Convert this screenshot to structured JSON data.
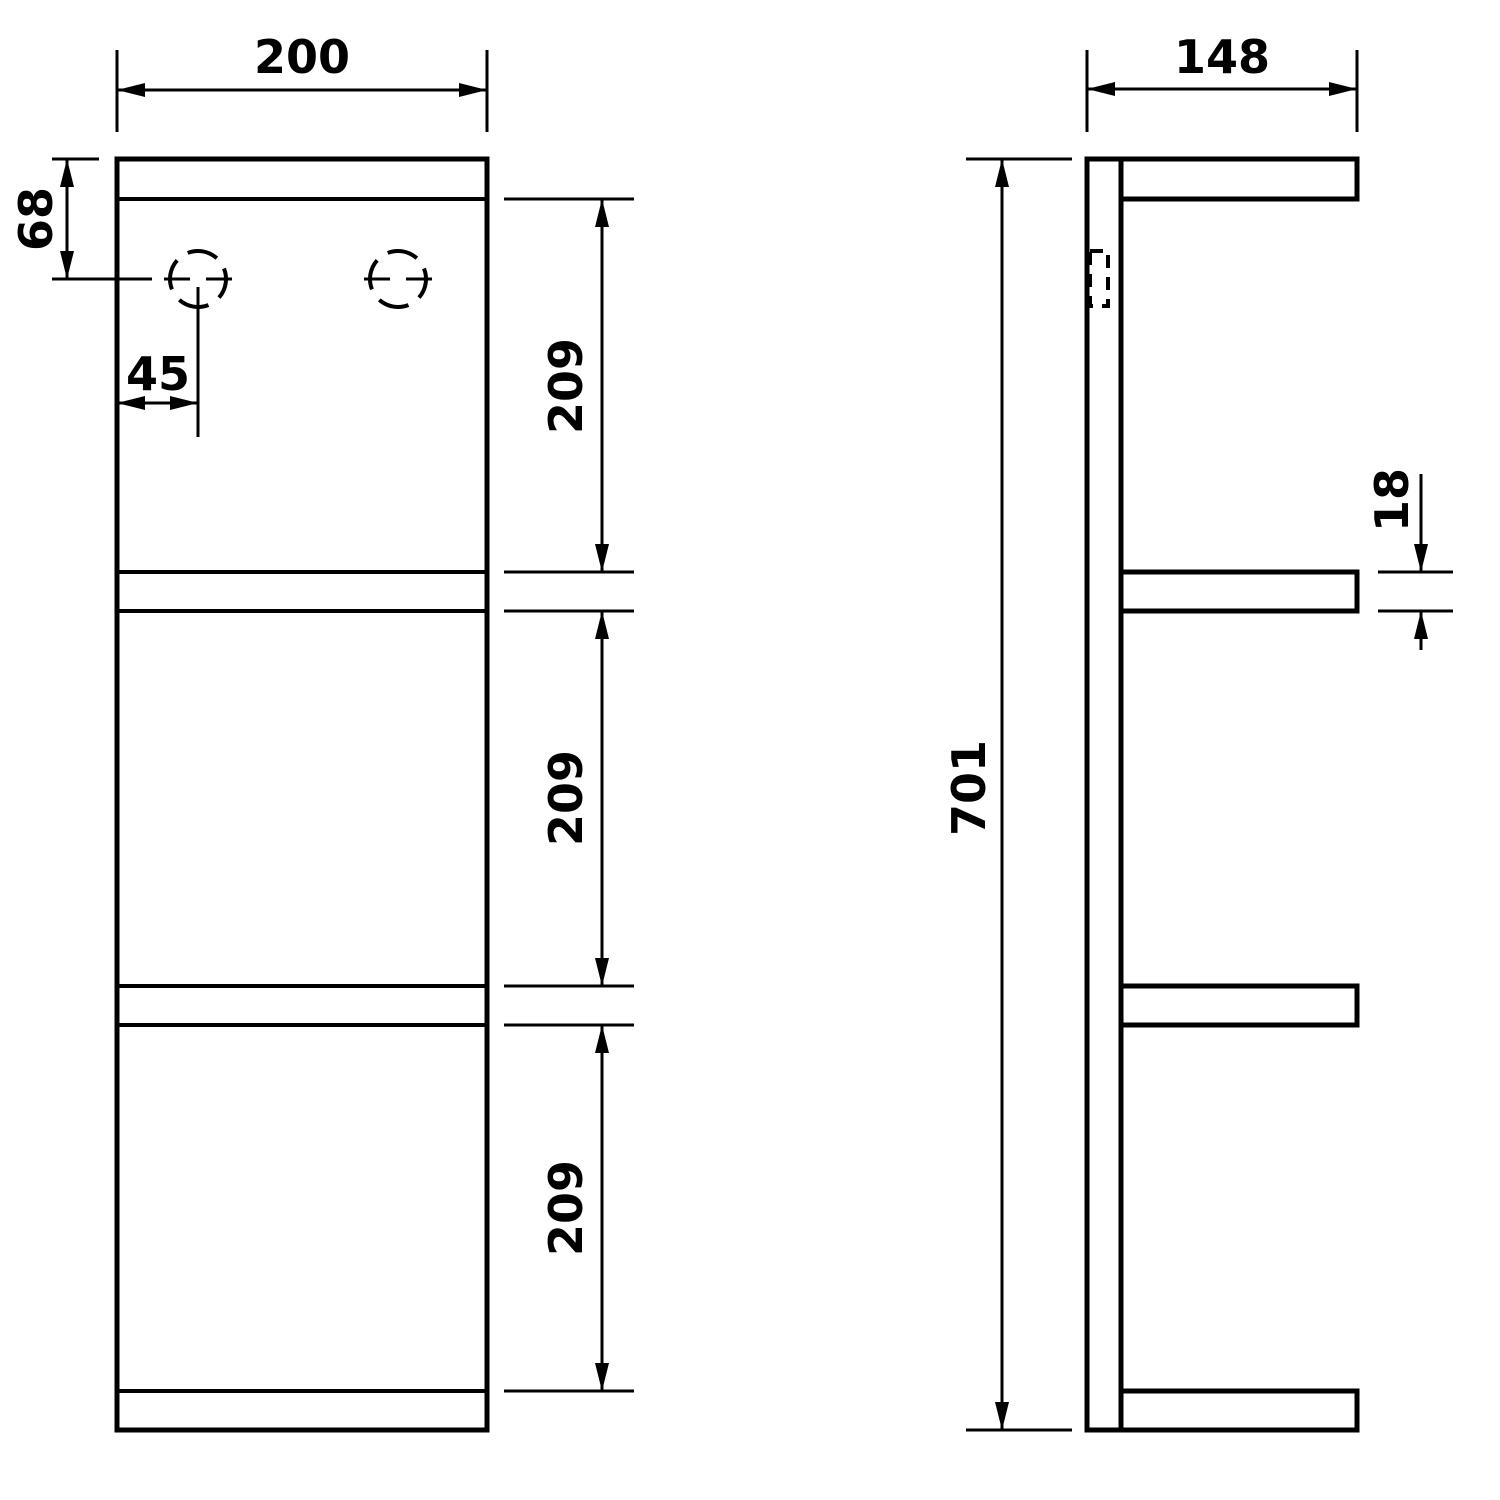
{
  "canvas": {
    "width": 1500,
    "height": 1500,
    "background_color": "#ffffff",
    "line_color": "#000000"
  },
  "front_view": {
    "dims": {
      "width": "200",
      "top_to_hole": "68",
      "hole_inset": "45",
      "opening_top": "209",
      "opening_middle": "209",
      "opening_bottom": "209"
    }
  },
  "side_view": {
    "dims": {
      "depth": "148",
      "overall_height": "701",
      "shelf_thickness": "18"
    }
  }
}
